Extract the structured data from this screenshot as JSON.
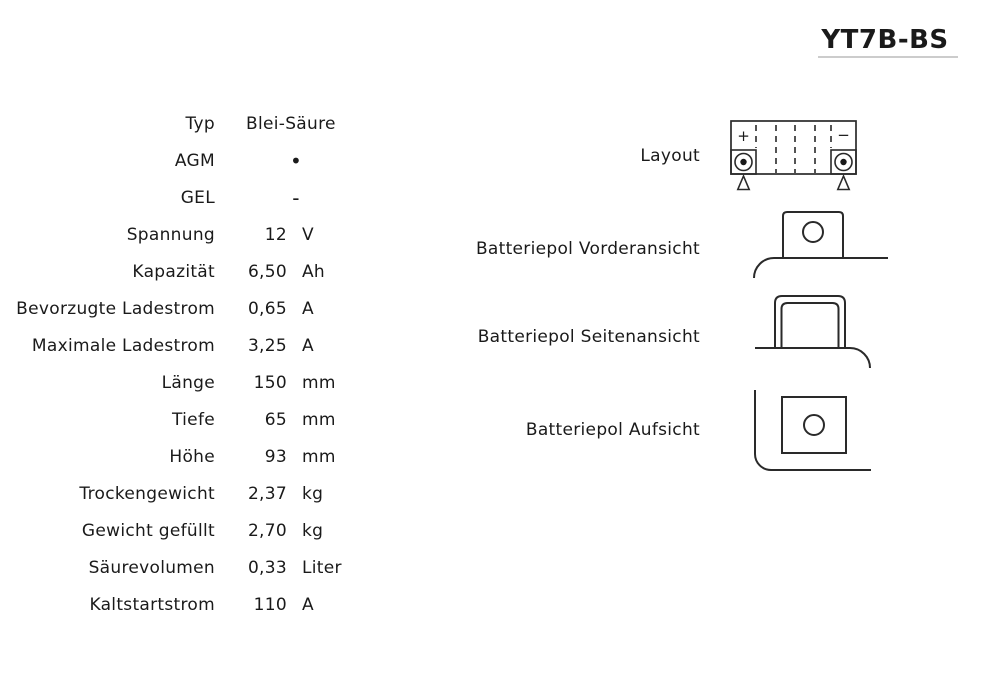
{
  "title": "YT7B-BS",
  "specs": {
    "rows": [
      {
        "label": "Typ",
        "value": "Blei-Säure",
        "unit": ""
      },
      {
        "label": "AGM",
        "value": "•",
        "unit": ""
      },
      {
        "label": "GEL",
        "value": "-",
        "unit": ""
      },
      {
        "label": "Spannung",
        "value": "12",
        "unit": "V"
      },
      {
        "label": "Kapazität",
        "value": "6,50",
        "unit": "Ah"
      },
      {
        "label": "Bevorzugte Ladestrom",
        "value": "0,65",
        "unit": "A"
      },
      {
        "label": "Maximale Ladestrom",
        "value": "3,25",
        "unit": "A"
      },
      {
        "label": "Länge",
        "value": "150",
        "unit": "mm"
      },
      {
        "label": "Tiefe",
        "value": "65",
        "unit": "mm"
      },
      {
        "label": "Höhe",
        "value": "93",
        "unit": "mm"
      },
      {
        "label": "Trockengewicht",
        "value": "2,37",
        "unit": "kg"
      },
      {
        "label": "Gewicht gefüllt",
        "value": "2,70",
        "unit": "kg"
      },
      {
        "label": "Säurevolumen",
        "value": "0,33",
        "unit": "Liter"
      },
      {
        "label": "Kaltstartstrom",
        "value": "110",
        "unit": "A"
      }
    ]
  },
  "diagrams": {
    "layout_label": "Layout",
    "front_label": "Batteriepol Vorderansicht",
    "side_label": "Batteriepol Seitenansicht",
    "top_label": "Batteriepol Aufsicht",
    "plus_sign": "+",
    "minus_sign": "−"
  },
  "colors": {
    "text": "#1a1a1a",
    "diagram_line": "#2a2a2a",
    "title_underline": "#cccccc",
    "background": "#ffffff"
  }
}
